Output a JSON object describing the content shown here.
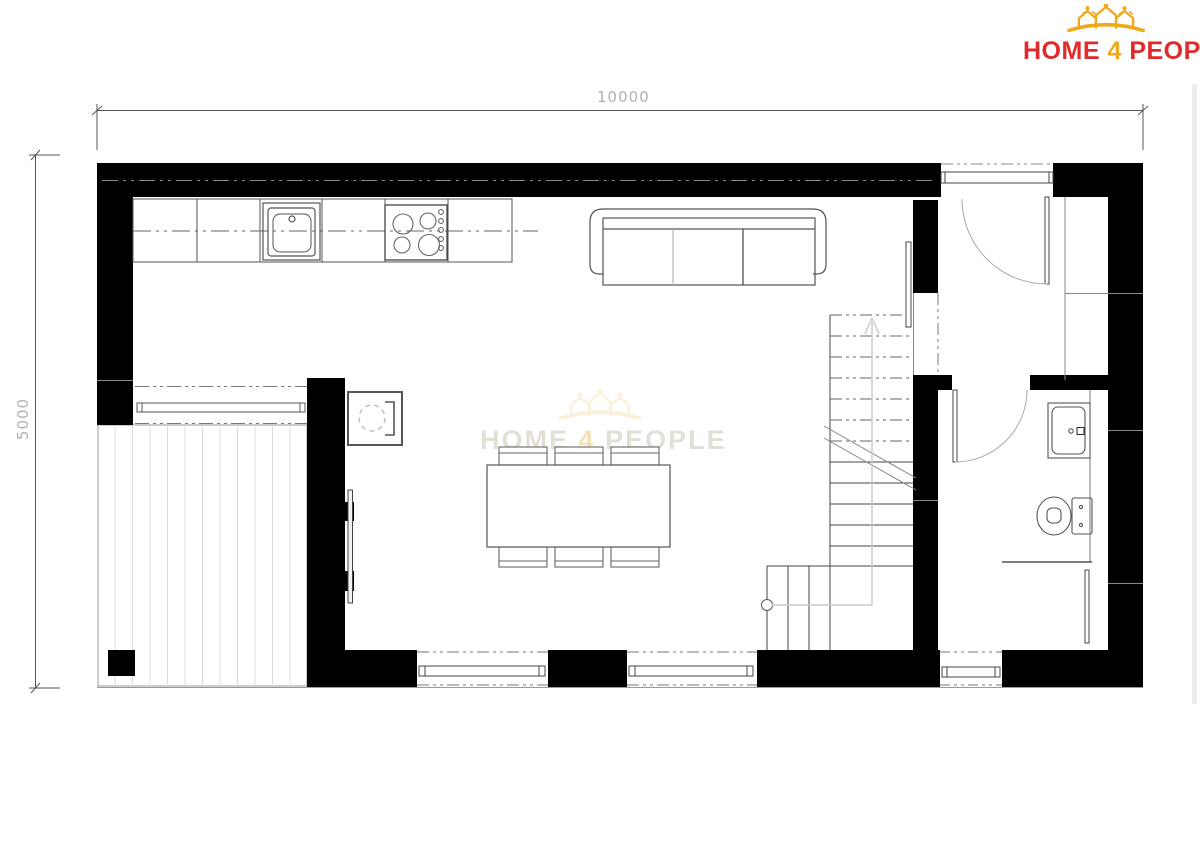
{
  "logo": {
    "home": "HOME",
    "four": "4",
    "people": "PEOPLE"
  },
  "dimensions": {
    "width_label": "10000",
    "height_label": "5000"
  },
  "watermark": {
    "home": "HOME",
    "four": "4",
    "people": "PEOPLE"
  },
  "colors": {
    "logo_red": "#e12a2b",
    "logo_yellow": "#efa91d",
    "wall_black": "#000000",
    "dimension_gray": "#b2b2b2"
  }
}
